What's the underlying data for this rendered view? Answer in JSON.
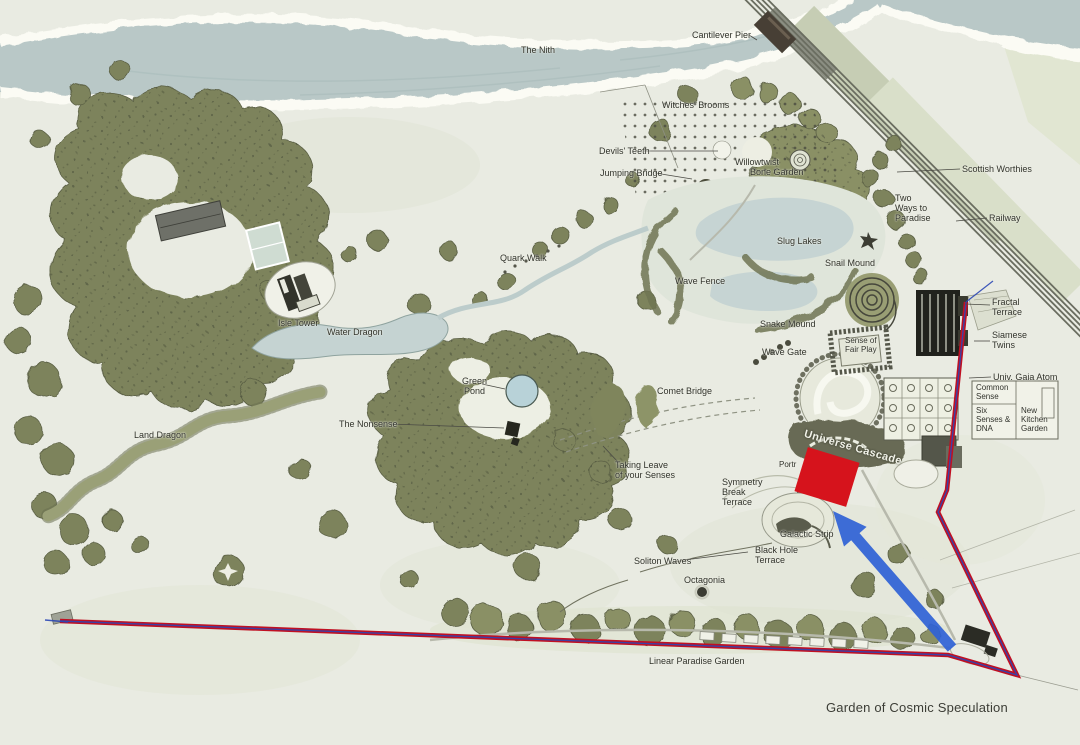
{
  "caption": "Garden of Cosmic Speculation",
  "map": {
    "labels": [
      {
        "id": "the-nith",
        "text": "The Nith",
        "x": 521,
        "y": 45
      },
      {
        "id": "cantilever-pier",
        "text": "Cantilever Pier",
        "x": 692,
        "y": 30
      },
      {
        "id": "witches-brooms",
        "text": "Witches' Brooms",
        "x": 662,
        "y": 100
      },
      {
        "id": "devils-teeth",
        "text": "Devils' Teeth",
        "x": 599,
        "y": 146
      },
      {
        "id": "jumping-bridge",
        "text": "Jumping Bridge",
        "x": 600,
        "y": 168
      },
      {
        "id": "willowtwist",
        "text": "Willowtwist",
        "x": 735,
        "y": 157
      },
      {
        "id": "bone-garden",
        "text": "Bone Garden",
        "x": 750,
        "y": 167
      },
      {
        "id": "scottish-worthies",
        "text": "Scottish Worthies",
        "x": 962,
        "y": 164
      },
      {
        "id": "two-ways-to-paradise",
        "text": "Two\nWays to\nParadise",
        "x": 895,
        "y": 193
      },
      {
        "id": "railway",
        "text": "Railway",
        "x": 989,
        "y": 213
      },
      {
        "id": "slug-lakes",
        "text": "Slug Lakes",
        "x": 777,
        "y": 236
      },
      {
        "id": "snail-mound",
        "text": "Snail Mound",
        "x": 825,
        "y": 258
      },
      {
        "id": "quark-walk",
        "text": "Quark Walk",
        "x": 500,
        "y": 253
      },
      {
        "id": "wave-fence",
        "text": "Wave Fence",
        "x": 675,
        "y": 276
      },
      {
        "id": "isle-tower",
        "text": "Isle Tower",
        "x": 278,
        "y": 318
      },
      {
        "id": "water-dragon",
        "text": "Water Dragon",
        "x": 327,
        "y": 327
      },
      {
        "id": "land-dragon",
        "text": "Land Dragon",
        "x": 134,
        "y": 430
      },
      {
        "id": "snake-mound",
        "text": "Snake Mound",
        "x": 760,
        "y": 319
      },
      {
        "id": "wave-gate",
        "text": "Wave Gate",
        "x": 762,
        "y": 347
      },
      {
        "id": "sense-of-fair-play",
        "text": "Sense of\nFair Play",
        "x": 845,
        "y": 337,
        "cls": "center small"
      },
      {
        "id": "fractal-terrace",
        "text": "Fractal\nTerrace",
        "x": 992,
        "y": 297
      },
      {
        "id": "siamese-twins",
        "text": "Siamese\nTwins",
        "x": 992,
        "y": 330
      },
      {
        "id": "univ-gaia-atom",
        "text": "Univ. Gaia Atom",
        "x": 993,
        "y": 372
      },
      {
        "id": "common-sense",
        "text": "Common\nSense",
        "x": 976,
        "y": 384,
        "cls": "small"
      },
      {
        "id": "six-senses-dna",
        "text": "Six\nSenses &\nDNA",
        "x": 976,
        "y": 407,
        "cls": "small"
      },
      {
        "id": "new-kitchen-garden",
        "text": "New\nKitchen\nGarden",
        "x": 1021,
        "y": 407,
        "cls": "small"
      },
      {
        "id": "green-pond",
        "text": "Green\nPond",
        "x": 462,
        "y": 376,
        "cls": "center"
      },
      {
        "id": "the-nonsense",
        "text": "The Nonsense",
        "x": 339,
        "y": 419
      },
      {
        "id": "comet-bridge",
        "text": "Comet Bridge",
        "x": 657,
        "y": 386
      },
      {
        "id": "universe-cascade",
        "text": "Universe Cascade",
        "x": 806,
        "y": 428,
        "cls": "cascade"
      },
      {
        "id": "portrack",
        "text": "Portr",
        "x": 779,
        "y": 461,
        "cls": "small"
      },
      {
        "id": "taking-leave",
        "text": "Taking Leave\nof your Senses",
        "x": 615,
        "y": 460
      },
      {
        "id": "symmetry-break-terrace",
        "text": "Symmetry\nBreak\nTerrace",
        "x": 722,
        "y": 477
      },
      {
        "id": "galactic-strip",
        "text": "Galactic Strip",
        "x": 780,
        "y": 529
      },
      {
        "id": "soliton-waves",
        "text": "Soliton Waves",
        "x": 634,
        "y": 556
      },
      {
        "id": "black-hole-terrace",
        "text": "Black Hole\nTerrace",
        "x": 755,
        "y": 545
      },
      {
        "id": "octagonia",
        "text": "Octagonia",
        "x": 684,
        "y": 575
      },
      {
        "id": "linear-paradise-garden",
        "text": "Linear Paradise Garden",
        "x": 649,
        "y": 656
      }
    ],
    "pointer_lines": [
      {
        "id": "cantilever-pier",
        "x1": 749,
        "y1": 35,
        "x2": 757,
        "y2": 40
      },
      {
        "id": "devils-teeth",
        "x1": 644,
        "y1": 151,
        "x2": 718,
        "y2": 151
      },
      {
        "id": "jumping-bridge",
        "x1": 655,
        "y1": 173,
        "x2": 692,
        "y2": 179
      },
      {
        "id": "scottish-worthies",
        "x1": 960,
        "y1": 169,
        "x2": 897,
        "y2": 172
      },
      {
        "id": "railway",
        "x1": 987,
        "y1": 218,
        "x2": 956,
        "y2": 221
      },
      {
        "id": "fractal-terrace",
        "x1": 990,
        "y1": 305,
        "x2": 965,
        "y2": 304
      },
      {
        "id": "siamese-twins",
        "x1": 990,
        "y1": 341,
        "x2": 974,
        "y2": 341
      },
      {
        "id": "univ-gaia-atom",
        "x1": 991,
        "y1": 377,
        "x2": 969,
        "y2": 378
      },
      {
        "id": "green-pond",
        "x1": 482,
        "y1": 384,
        "x2": 505,
        "y2": 389
      },
      {
        "id": "the-nonsense",
        "x1": 390,
        "y1": 424,
        "x2": 504,
        "y2": 428
      },
      {
        "id": "taking-leave",
        "x1": 618,
        "y1": 462,
        "x2": 603,
        "y2": 446
      },
      {
        "id": "soliton-waves",
        "x1": 684,
        "y1": 560,
        "x2": 748,
        "y2": 552
      }
    ],
    "route": {
      "color": "#c01022",
      "accent_color": "#2b47b5",
      "points": "60,621 948,655 1017,675 938,512 947,490 966,302",
      "accent_left_tail": "45,620 68,622",
      "accent_top_tail": "966,302 993,281"
    },
    "markers": {
      "highlight_square_color": "#d6131c",
      "arrow_color": "#2f62d6"
    }
  }
}
